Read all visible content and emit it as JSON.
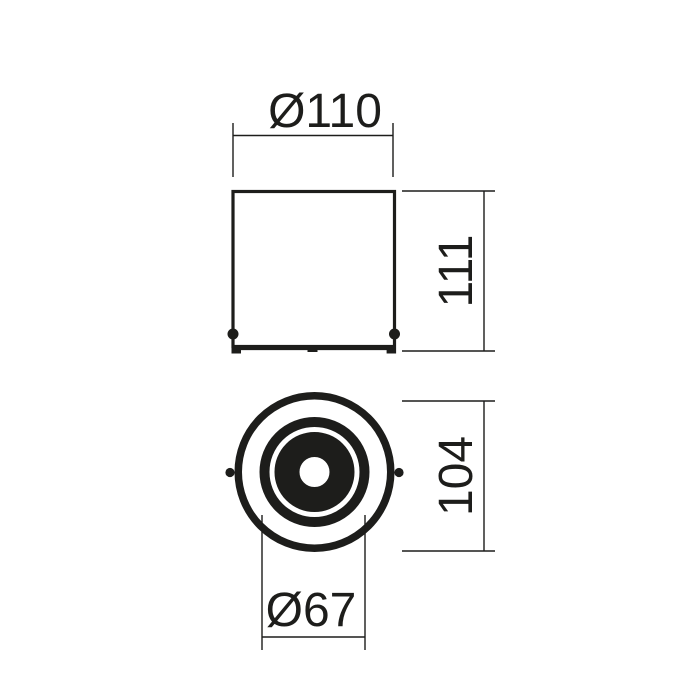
{
  "canvas": {
    "background": "#ffffff",
    "ink": "#1d1d1b"
  },
  "drawing": {
    "kind": "dimensioned technical drawing, side view and bottom view of cylindrical surface-mounted downlight",
    "labels": {
      "top_diameter": "Ø110",
      "height": "111",
      "body_height": "104",
      "aperture_diameter": "Ø67"
    }
  }
}
